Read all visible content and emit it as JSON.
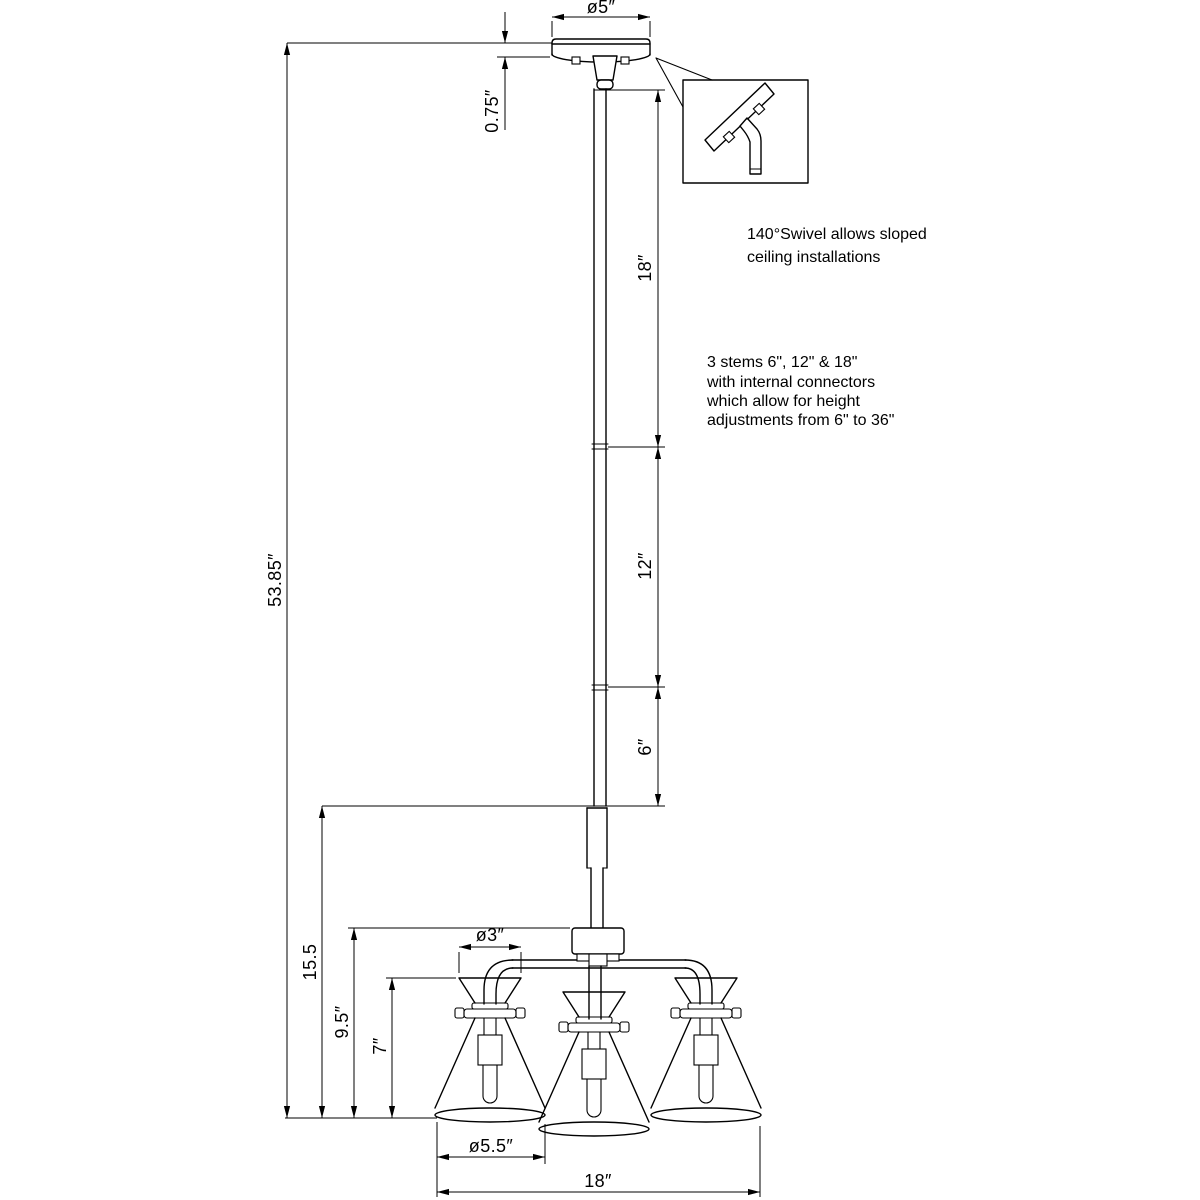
{
  "drawing": {
    "type": "technical-dimension-drawing",
    "subject": "3-light pendant chandelier with cone glass shades and adjustable downrod",
    "colors": {
      "line": "#000000",
      "background": "#ffffff"
    },
    "dims": {
      "canopy_diameter": "ø5″",
      "canopy_height": "0.75″",
      "stem_18": "18″",
      "stem_12": "12″",
      "stem_6": "6″",
      "overall_height": "53.85″",
      "body_height": "15.5",
      "hub_to_bottom": "9.5″",
      "shade_height": "7″",
      "shade_top_diameter": "ø3″",
      "shade_diameter": "ø5.5″",
      "fixture_width": "18″"
    },
    "notes": {
      "swivel": {
        "line1": "140°Swivel allows sloped",
        "line2": "ceiling installations"
      },
      "stems": {
        "line1": "3 stems 6\", 12\" & 18\"",
        "line2": "with internal connectors",
        "line3": "which allow for height",
        "line4": "adjustments from 6\" to 36\""
      }
    }
  }
}
